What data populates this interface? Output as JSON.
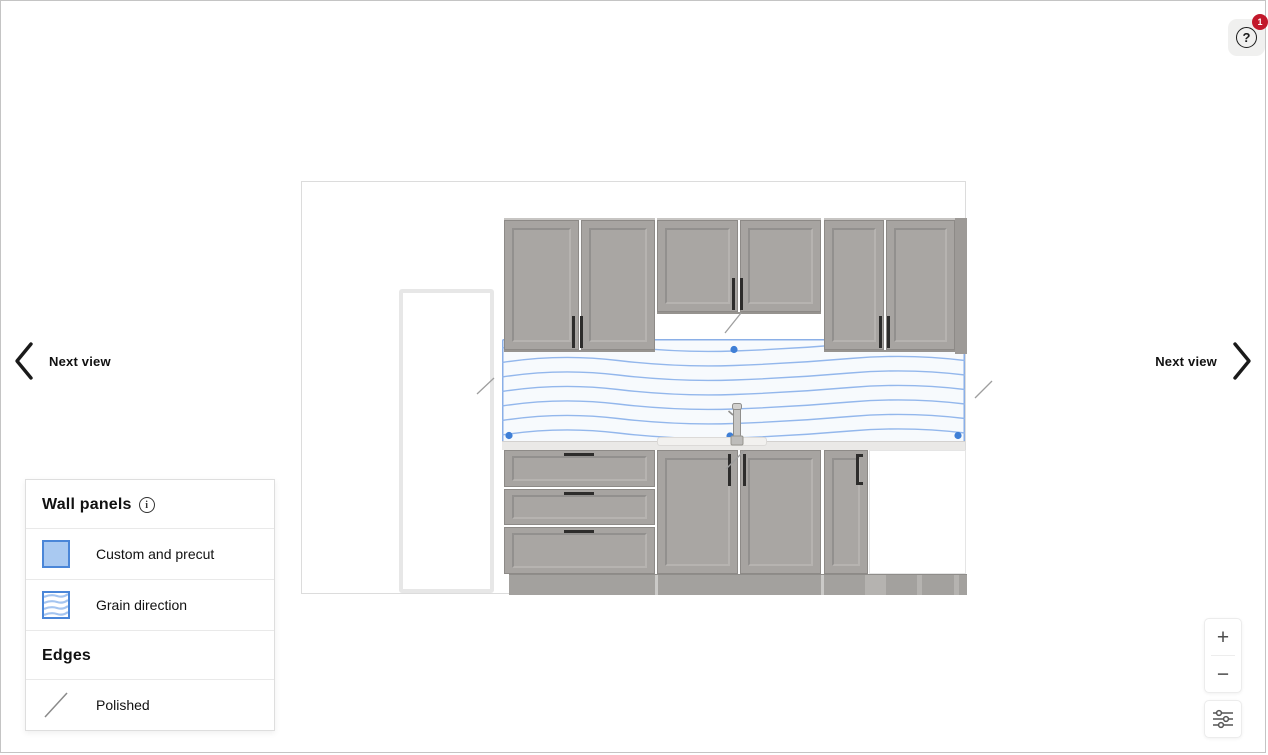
{
  "header": {
    "help_badge": "1"
  },
  "icons": {
    "help_glyph": "?",
    "info_glyph": "i"
  },
  "nav": {
    "prev": {
      "label": "Next view"
    },
    "next": {
      "label": "Next view"
    }
  },
  "legend": {
    "title": "Wall panels",
    "items": [
      {
        "label": "Custom and precut",
        "swatch": "filled-blue-square"
      },
      {
        "label": "Grain direction",
        "swatch": "wavy-lines-square"
      }
    ],
    "edges_title": "Edges",
    "edges_items": [
      {
        "label": "Polished",
        "swatch": "diagonal-line"
      }
    ]
  },
  "controls": {
    "zoom_in": "+",
    "zoom_out": "−"
  },
  "colors": {
    "accent_blue": "#4a86d8",
    "panel_fill": "#f7fafd",
    "panel_border": "#8aafe7",
    "grain_line": "#93b7ec",
    "badge_red": "#c2182b",
    "cabinet_gray": "#a7a4a1",
    "toe_kick_gray": "#a3a19e"
  }
}
